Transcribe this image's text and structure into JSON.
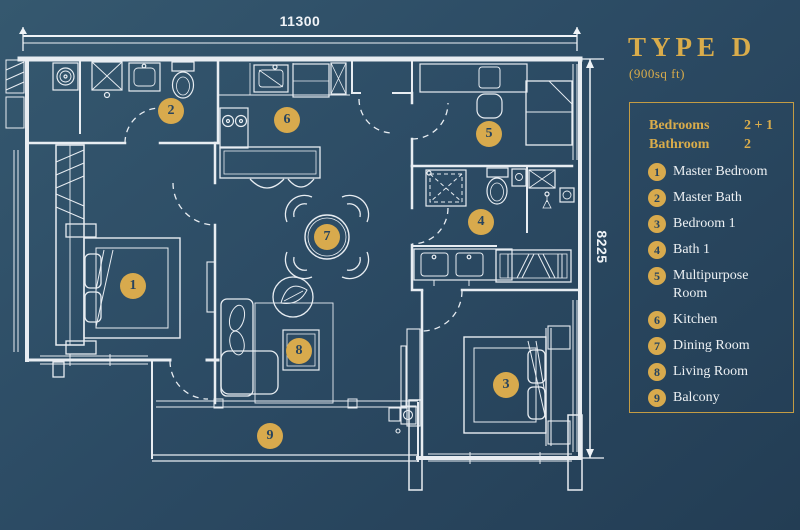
{
  "panel": {
    "title": "TYPE D",
    "subtitle": "(900sq ft)",
    "stats": [
      {
        "label": "Bedrooms",
        "value": "2 + 1"
      },
      {
        "label": "Bathroom",
        "value": "2"
      }
    ],
    "items": [
      {
        "num": "1",
        "label": "Master Bedroom"
      },
      {
        "num": "2",
        "label": "Master Bath"
      },
      {
        "num": "3",
        "label": "Bedroom 1"
      },
      {
        "num": "4",
        "label": "Bath 1"
      },
      {
        "num": "5",
        "label": "Multipurpose Room"
      },
      {
        "num": "6",
        "label": "Kitchen"
      },
      {
        "num": "7",
        "label": "Dining Room"
      },
      {
        "num": "8",
        "label": "Living Room"
      },
      {
        "num": "9",
        "label": "Balcony"
      }
    ]
  },
  "plan": {
    "dimensions": {
      "width": "11300",
      "height": "8225"
    },
    "markers": [
      {
        "num": "1",
        "x": 133,
        "y": 286
      },
      {
        "num": "2",
        "x": 171,
        "y": 111
      },
      {
        "num": "3",
        "x": 506,
        "y": 385
      },
      {
        "num": "4",
        "x": 481,
        "y": 222
      },
      {
        "num": "5",
        "x": 489,
        "y": 134
      },
      {
        "num": "6",
        "x": 287,
        "y": 120
      },
      {
        "num": "7",
        "x": 327,
        "y": 237
      },
      {
        "num": "8",
        "x": 299,
        "y": 351
      },
      {
        "num": "9",
        "x": 270,
        "y": 436
      }
    ],
    "colors": {
      "background": "#2C4B64",
      "lines": "#E8EDF2",
      "accent": "#D8AA4D"
    }
  }
}
